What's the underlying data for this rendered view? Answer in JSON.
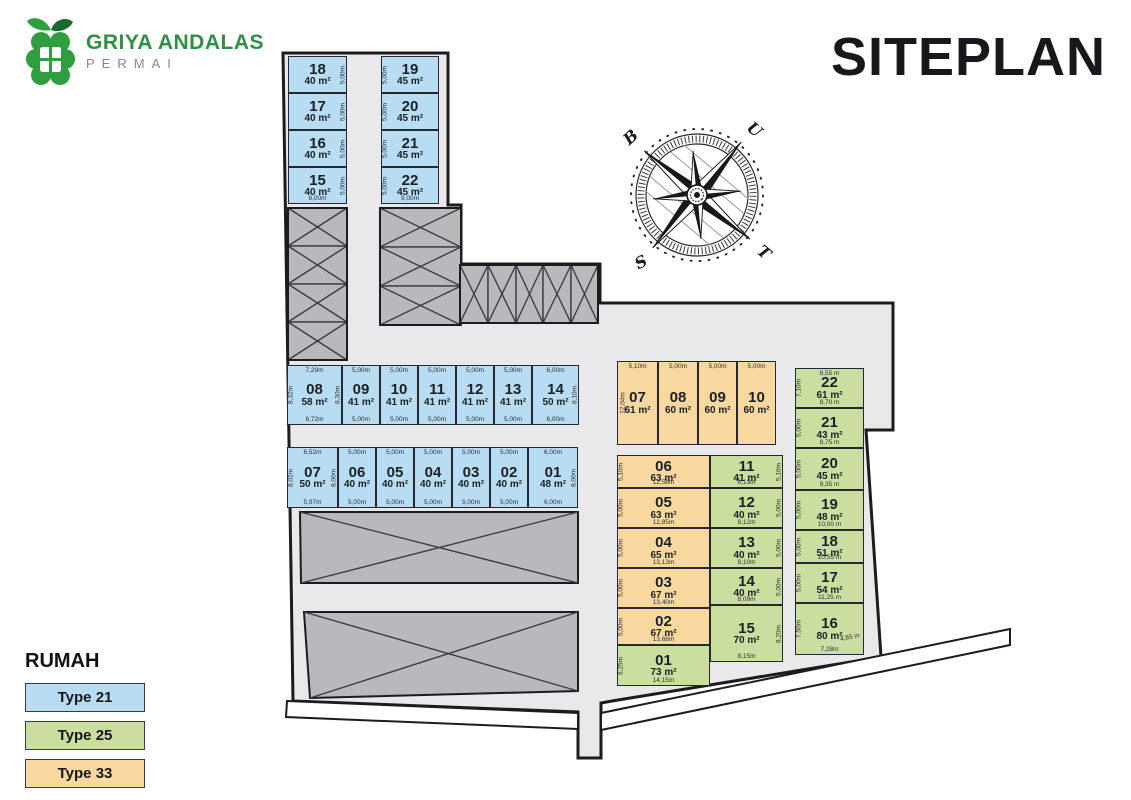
{
  "brand": {
    "line1": "GRIYA ANDALAS",
    "line2": "PERMAI"
  },
  "title": "SITEPLAN",
  "compass": {
    "north": "U",
    "east": "T",
    "south": "S",
    "west": "B"
  },
  "legend": {
    "title": "RUMAH",
    "items": [
      {
        "label": "Type 21",
        "color": "#b8dcf2"
      },
      {
        "label": "Type 25",
        "color": "#cadf9f"
      },
      {
        "label": "Type 33",
        "color": "#f9d8a0"
      }
    ]
  },
  "colors": {
    "road": "#e9e9ec",
    "hatched_block": "#b9b9bd",
    "outline": "#1c1c1e"
  },
  "site": {
    "groups": {
      "blueTopLeft": [
        {
          "num": "18",
          "area": "40 m²",
          "type": "21",
          "dims": {
            "right": "5,00m"
          }
        },
        {
          "num": "17",
          "area": "40 m²",
          "type": "21",
          "dims": {
            "right": "5,00m"
          }
        },
        {
          "num": "16",
          "area": "40 m²",
          "type": "21",
          "dims": {
            "right": "5,00m"
          }
        },
        {
          "num": "15",
          "area": "40 m²",
          "type": "21",
          "dims": {
            "right": "5,00m",
            "bottom": "8,00m"
          }
        }
      ],
      "blueTopRight": [
        {
          "num": "19",
          "area": "45 m²",
          "type": "21",
          "dims": {
            "left": "5,00m"
          }
        },
        {
          "num": "20",
          "area": "45 m²",
          "type": "21",
          "dims": {
            "left": "5,00m"
          }
        },
        {
          "num": "21",
          "area": "45 m²",
          "type": "21",
          "dims": {
            "left": "5,00m"
          }
        },
        {
          "num": "22",
          "area": "45 m²",
          "type": "21",
          "dims": {
            "left": "5,00m",
            "bottom": "9,00m"
          }
        }
      ],
      "rowTop": [
        {
          "num": "08",
          "area": "58 m²",
          "type": "21",
          "dims": {
            "top": "7,29m",
            "bottom": "6,72m",
            "left": "8,32m",
            "right": "8,30m"
          }
        },
        {
          "num": "09",
          "area": "41 m²",
          "type": "21",
          "dims": {
            "top": "5,00m",
            "bottom": "5,00m"
          }
        },
        {
          "num": "10",
          "area": "41 m²",
          "type": "21",
          "dims": {
            "top": "5,00m",
            "bottom": "5,00m"
          }
        },
        {
          "num": "11",
          "area": "41 m²",
          "type": "21",
          "dims": {
            "top": "5,00m",
            "bottom": "5,00m"
          }
        },
        {
          "num": "12",
          "area": "41 m²",
          "type": "21",
          "dims": {
            "top": "5,00m",
            "bottom": "5,00m"
          }
        },
        {
          "num": "13",
          "area": "41 m²",
          "type": "21",
          "dims": {
            "top": "5,00m",
            "bottom": "5,00m"
          }
        },
        {
          "num": "14",
          "area": "50 m²",
          "type": "21",
          "dims": {
            "top": "6,00m",
            "bottom": "6,00m",
            "right": "8,10m"
          }
        }
      ],
      "rowBottom": [
        {
          "num": "07",
          "area": "50 m²",
          "type": "21",
          "dims": {
            "top": "6,52m",
            "bottom": "5,97m",
            "left": "8,02m",
            "right": "8,00m"
          }
        },
        {
          "num": "06",
          "area": "40 m²",
          "type": "21",
          "dims": {
            "top": "5,00m",
            "bottom": "5,00m"
          }
        },
        {
          "num": "05",
          "area": "40 m²",
          "type": "21",
          "dims": {
            "top": "5,00m",
            "bottom": "5,00m"
          }
        },
        {
          "num": "04",
          "area": "40 m²",
          "type": "21",
          "dims": {
            "top": "5,00m",
            "bottom": "5,00m"
          }
        },
        {
          "num": "03",
          "area": "40 m²",
          "type": "21",
          "dims": {
            "top": "5,00m",
            "bottom": "5,00m"
          }
        },
        {
          "num": "02",
          "area": "40 m²",
          "type": "21",
          "dims": {
            "top": "5,00m",
            "bottom": "5,00m"
          }
        },
        {
          "num": "01",
          "area": "48 m²",
          "type": "21",
          "dims": {
            "top": "6,00m",
            "bottom": "6,00m",
            "right": "8,00m"
          }
        }
      ],
      "orangeRow": [
        {
          "num": "07",
          "area": "61 m²",
          "type": "33",
          "dims": {
            "top": "5,10m",
            "left": "12,04m"
          }
        },
        {
          "num": "08",
          "area": "60 m²",
          "type": "33",
          "dims": {
            "top": "5,00m"
          }
        },
        {
          "num": "09",
          "area": "60 m²",
          "type": "33",
          "dims": {
            "top": "5,00m"
          }
        },
        {
          "num": "10",
          "area": "60 m²",
          "type": "33",
          "dims": {
            "top": "5,00m"
          }
        }
      ],
      "colLeft": [
        {
          "num": "06",
          "area": "63 m²",
          "type": "33",
          "dims": {
            "left": "5,10m",
            "bottom": "12,58m"
          }
        },
        {
          "num": "05",
          "area": "63 m²",
          "type": "33",
          "dims": {
            "left": "5,00m",
            "bottom": "12,85m"
          }
        },
        {
          "num": "04",
          "area": "65 m²",
          "type": "33",
          "dims": {
            "left": "5,00m",
            "bottom": "13,13m"
          }
        },
        {
          "num": "03",
          "area": "67 m²",
          "type": "33",
          "dims": {
            "left": "5,00m",
            "bottom": "13,40m"
          }
        },
        {
          "num": "02",
          "area": "67 m²",
          "type": "33",
          "dims": {
            "left": "5,00m",
            "bottom": "13,68m"
          }
        },
        {
          "num": "01",
          "area": "73 m²",
          "type": "25",
          "dims": {
            "left": "6,25m",
            "bottom": "14,15m"
          }
        }
      ],
      "colMid": [
        {
          "num": "11",
          "area": "41 m²",
          "type": "25",
          "dims": {
            "right": "5,10m",
            "bottom": "8,13m"
          }
        },
        {
          "num": "12",
          "area": "40 m²",
          "type": "25",
          "dims": {
            "right": "5,00m",
            "bottom": "8,12m"
          }
        },
        {
          "num": "13",
          "area": "40 m²",
          "type": "25",
          "dims": {
            "right": "5,00m",
            "bottom": "8,10m"
          }
        },
        {
          "num": "14",
          "area": "40 m²",
          "type": "25",
          "dims": {
            "right": "5,00m",
            "bottom": "8,09m"
          }
        },
        {
          "num": "15",
          "area": "70 m²",
          "type": "25",
          "dims": {
            "right": "8,20m",
            "bottom": "8,15m"
          }
        }
      ],
      "colRight": [
        {
          "num": "22",
          "area": "61 m²",
          "type": "25",
          "dims": {
            "top": "8,55 m",
            "left": "7,10m",
            "bottom": "8,70 m"
          }
        },
        {
          "num": "21",
          "area": "43 m²",
          "type": "25",
          "dims": {
            "left": "5,00m",
            "bottom": "8,75 m"
          }
        },
        {
          "num": "20",
          "area": "45 m²",
          "type": "25",
          "dims": {
            "left": "5,00m",
            "bottom": "9,35 m"
          }
        },
        {
          "num": "19",
          "area": "48 m²",
          "type": "25",
          "dims": {
            "left": "5,00m",
            "bottom": "10,00 m"
          }
        },
        {
          "num": "18",
          "area": "51 m²",
          "type": "25",
          "dims": {
            "left": "5,00m",
            "bottom": "10,55 m"
          }
        },
        {
          "num": "17",
          "area": "54 m²",
          "type": "25",
          "dims": {
            "left": "5,00m",
            "bottom": "11,25 m"
          }
        },
        {
          "num": "16",
          "area": "80 m²",
          "type": "25",
          "dims": {
            "left": "7,50m",
            "bottom": "7,28m",
            "diag": "4,85 m"
          }
        }
      ]
    }
  }
}
